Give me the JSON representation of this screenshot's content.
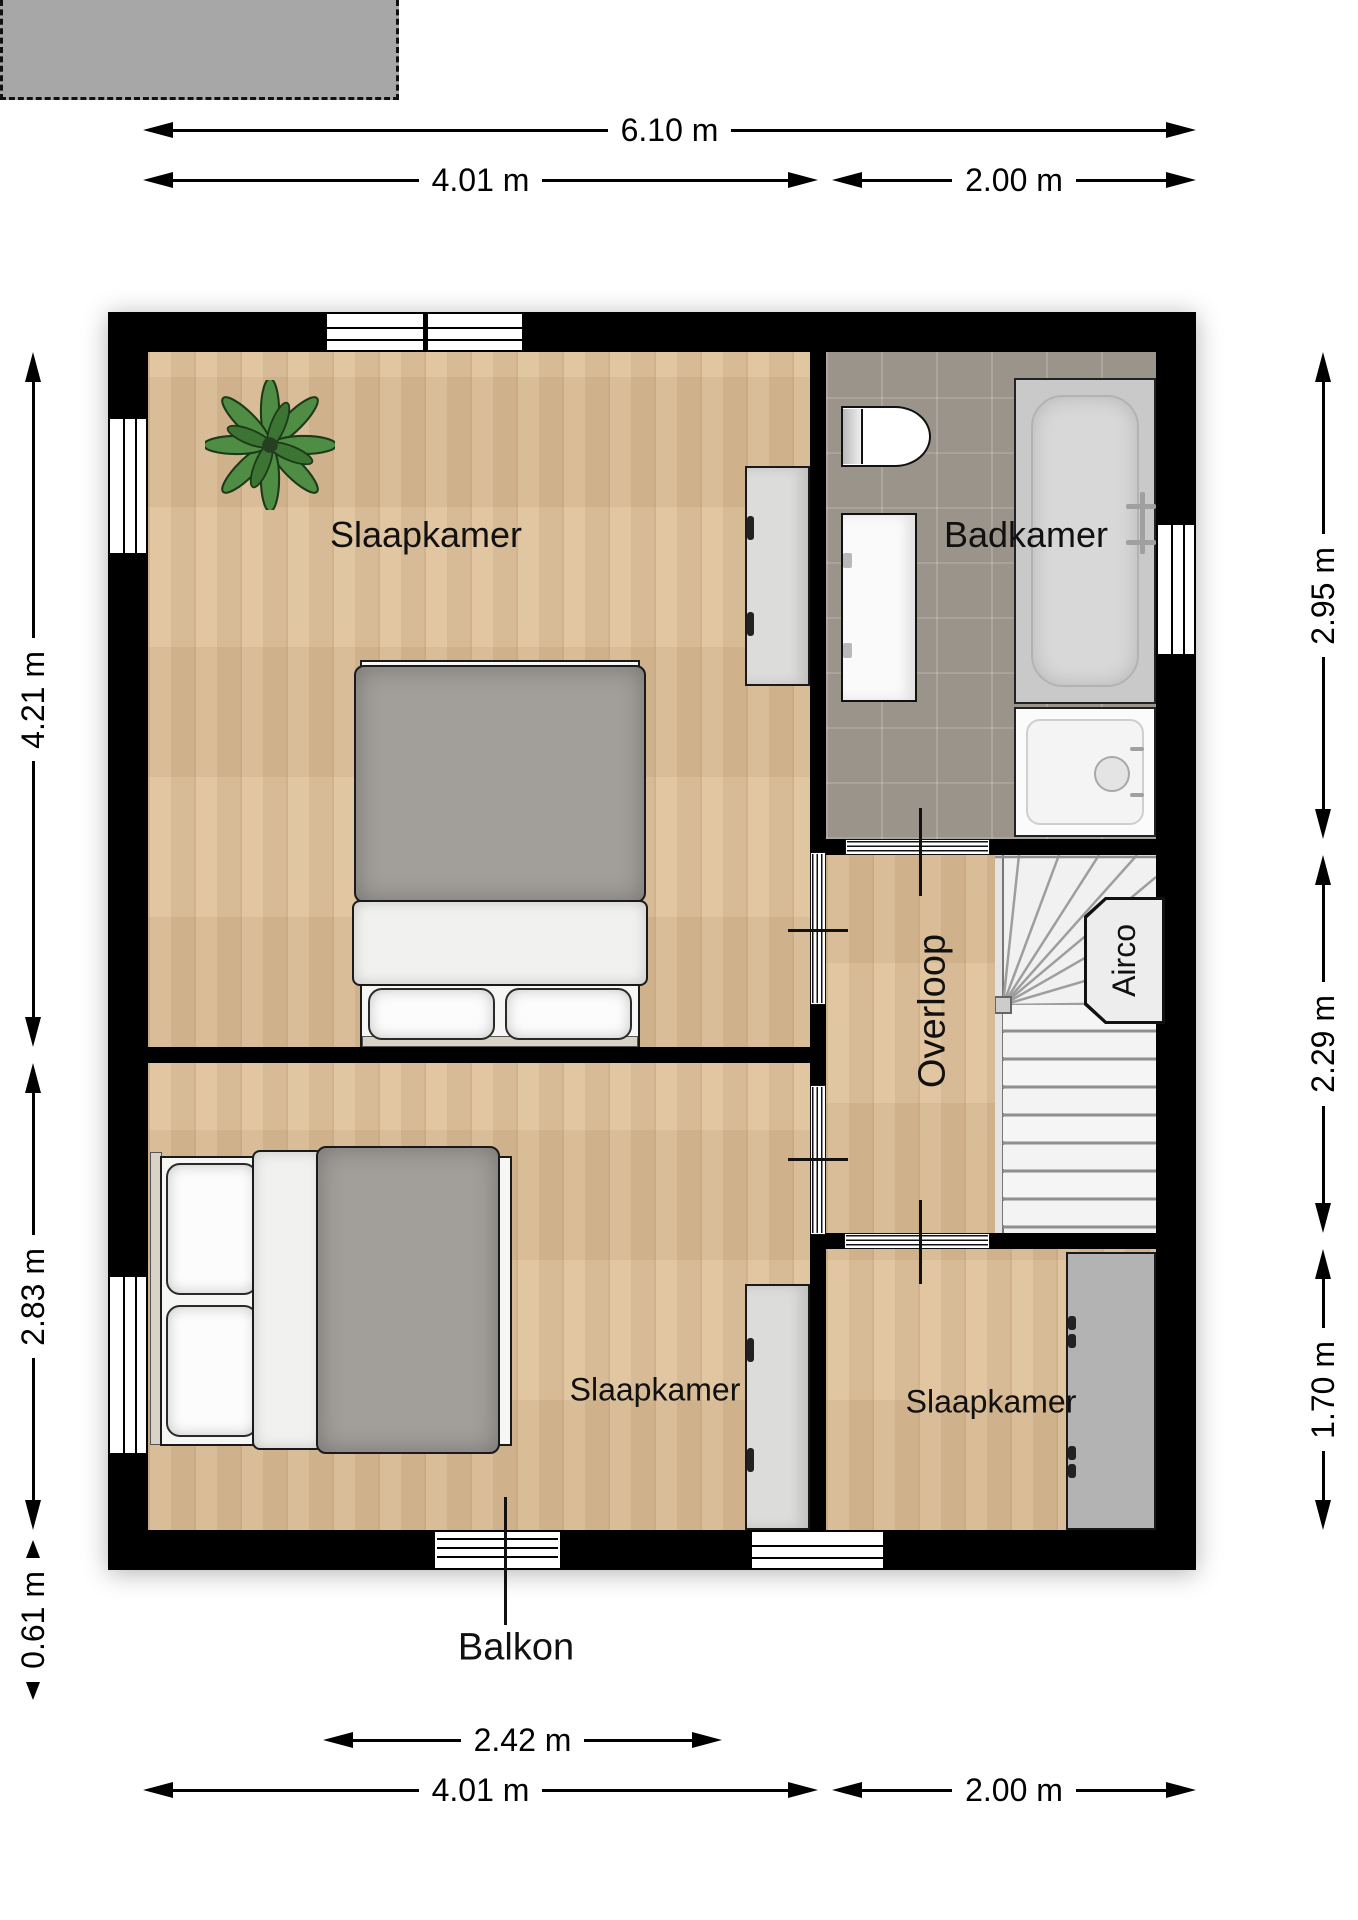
{
  "floorplan": {
    "rooms": {
      "bedroom_top_left": "Slaapkamer",
      "bedroom_bottom_left": "Slaapkamer",
      "bedroom_bottom_right": "Slaapkamer",
      "bathroom": "Badkamer",
      "landing": "Overloop",
      "airco_unit": "Airco",
      "balcony": "Balkon"
    },
    "dimensions": {
      "top_total": "6.10 m",
      "top_left": "4.01 m",
      "top_right": "2.00 m",
      "left_upper": "4.21 m",
      "left_lower": "2.83 m",
      "left_balcony_depth": "0.61 m",
      "right_upper": "2.95 m",
      "right_middle": "2.29 m",
      "right_lower": "1.70 m",
      "bottom_balcony": "2.42 m",
      "bottom_left": "4.01 m",
      "bottom_right": "2.00 m"
    },
    "colors": {
      "wall": "#000000",
      "wood_floor": "#debf97",
      "tile_floor": "#9a948a",
      "balcony_floor": "#a7a7a7",
      "wardrobe": "#b3b3b3",
      "duvet": "#a29f9b"
    }
  }
}
